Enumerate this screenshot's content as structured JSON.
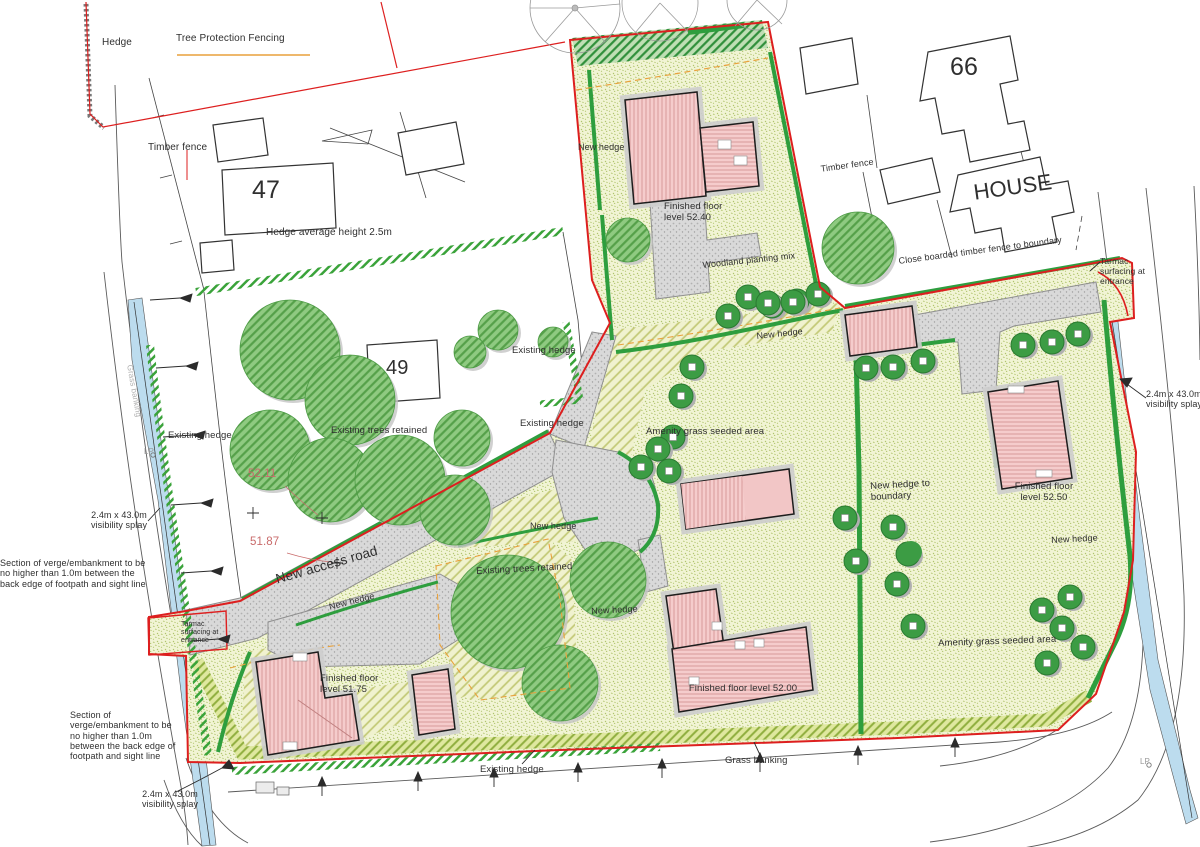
{
  "drawing": {
    "type": "residential development site plan",
    "colors": {
      "site_boundary_red": "#dd1f1f",
      "hedge_green": "#2e9e3e",
      "grass_area": "#f1f4d4",
      "road_grey": "#d9d9d9",
      "new_building_pink": "#f5cccc",
      "visibility_splay_blue": "#bcdcee",
      "tree_protection_orange": "#e8a13c",
      "spot_level_red": "#c96b6b"
    }
  },
  "labels": {
    "hedge": "Hedge",
    "tree_protection_fencing": "Tree Protection Fencing",
    "timber_fence": "Timber fence",
    "n47": "47",
    "n49": "49",
    "n66": "66",
    "house": "HOUSE",
    "hedge_avg": "Hedge average height 2.5m",
    "close_boarded": "Close boarded timber fence to boundary",
    "tarmac": "Tarmac surfacing at entrance",
    "splay": "2.4m x 43.0m visibility splay",
    "new_hedge": "New hedge",
    "new_hedge_boundary": "New hedge to boundary",
    "ffl_5240": "Finished floor level 52.40",
    "ffl_5250": "Finished floor level 52.50",
    "ffl_5200": "Finished floor level 52.00",
    "ffl_5175": "Finished floor level 51.75",
    "woodland": "Woodland planting mix",
    "existing_hedge": "Existing hedge",
    "existing_trees": "Existing trees retained",
    "amenity": "Amenity grass seeded area",
    "new_access_road": "New access road",
    "grass_banking": "Grass banking",
    "verge": "Section of verge/embankment to be no higher than 1.0m between the back edge of footpath and sight line",
    "spot_5211": "52.11",
    "spot_5187": "51.87",
    "lp": "LP"
  }
}
